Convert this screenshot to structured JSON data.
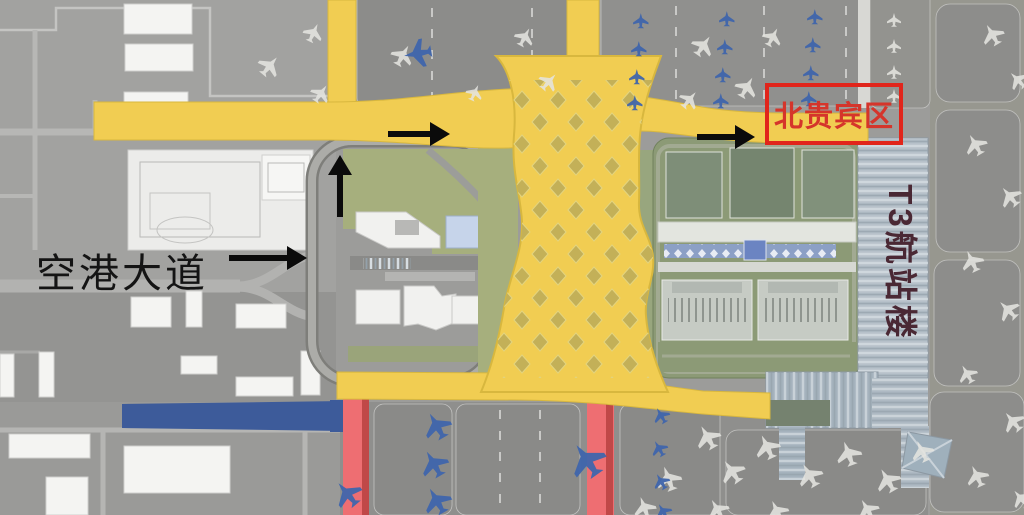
{
  "map": {
    "type": "airport-layout-map",
    "labels": {
      "airport_avenue": "空港大道",
      "north_vip_area": "北贵宾区",
      "t3_terminal": "T3航站楼"
    },
    "colors": {
      "vip_box_red": "#E1251B",
      "vip_text_red": "#D5352B",
      "annotation_black": "#0B0B0B",
      "road_yellow": "#F1CD52",
      "road_red": "#EE6E72",
      "transit_blue": "#3D5B9A",
      "t3_text_maroon": "#4A2834",
      "apron_gray": "#8F8F8D",
      "lawn_green": "#A6AF7D"
    },
    "arrows": [
      {
        "name": "airport-avenue-arrow",
        "direction": "right"
      },
      {
        "name": "loop-road-arrow",
        "direction": "up"
      },
      {
        "name": "north-road-arrow",
        "direction": "right"
      },
      {
        "name": "vip-approach-arrow",
        "direction": "right"
      }
    ]
  }
}
